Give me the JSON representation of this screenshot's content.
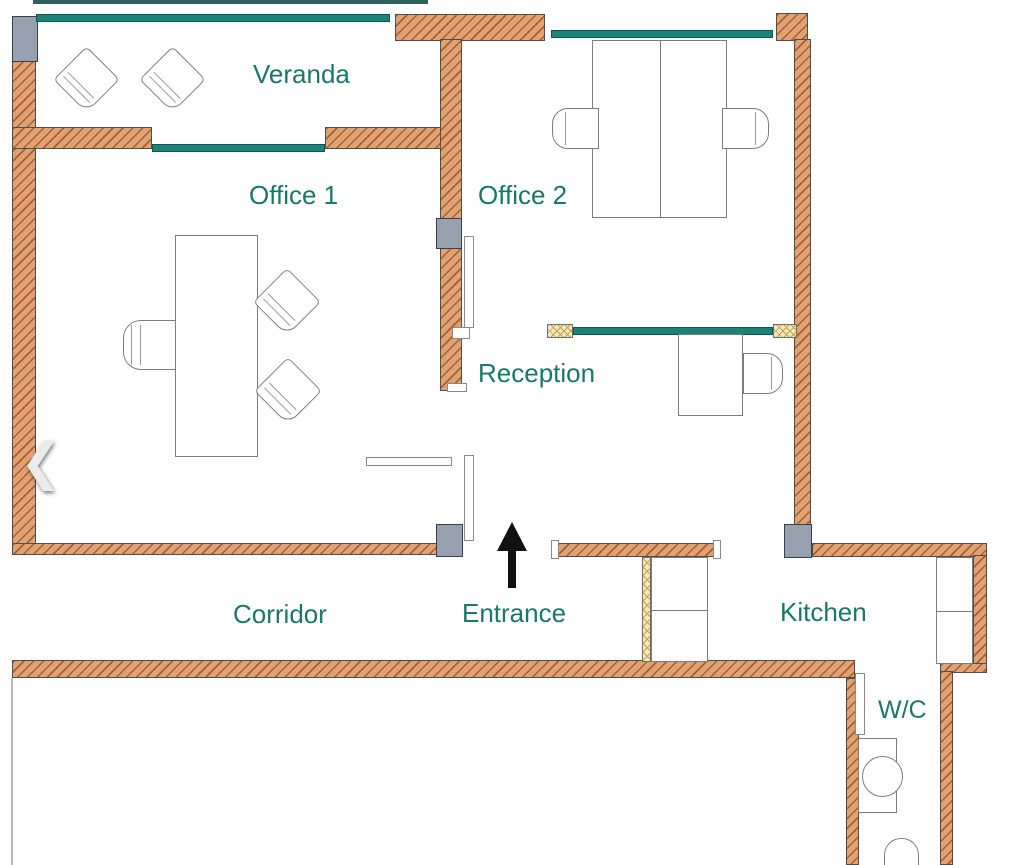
{
  "rooms": {
    "veranda": {
      "label": "Veranda"
    },
    "office1": {
      "label": "Office 1"
    },
    "office2": {
      "label": "Office 2"
    },
    "reception": {
      "label": "Reception"
    },
    "corridor": {
      "label": "Corridor"
    },
    "entrance": {
      "label": "Entrance"
    },
    "kitchen": {
      "label": "Kitchen"
    },
    "wc": {
      "label": "W/C"
    }
  },
  "navigation": {
    "previous_icon": "❮"
  },
  "colors": {
    "wall_fill": "#e0a273",
    "wall_hatch": "#a85e30",
    "wall_border": "#4e4e4e",
    "window_teal": "#1d8379",
    "window_outer_line": "#2e5f5a",
    "label_text": "#17786b",
    "pier_fill": "#97a0af",
    "pier_border": "#39404d",
    "partition_fill": "#f5e9c0",
    "partition_hatch": "#c2a24b",
    "furniture_fill": "#ffffff",
    "furniture_border": "#7d7d7d",
    "arrow_black": "#111111",
    "chevron": "#ebebeb",
    "page_bg": "#ffffff"
  }
}
